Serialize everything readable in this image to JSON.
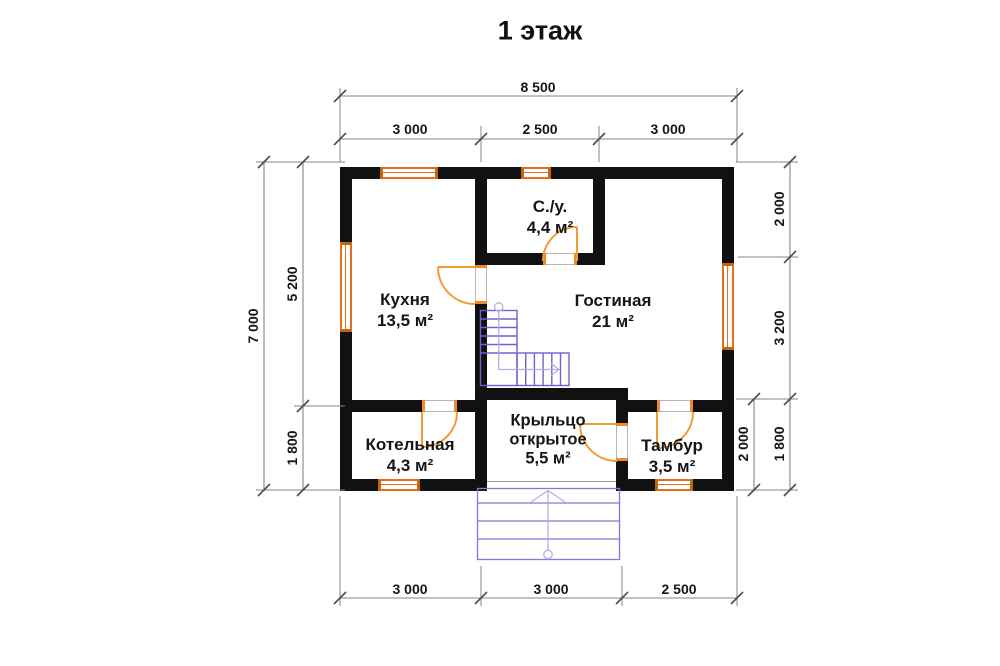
{
  "title": "1 этаж",
  "rooms": [
    {
      "id": "kitchen",
      "name": "Кухня",
      "area": "13,5 м²"
    },
    {
      "id": "bathroom",
      "name": "С./у.",
      "area": "4,4 м²"
    },
    {
      "id": "living",
      "name": "Гостиная",
      "area": "21 м²"
    },
    {
      "id": "boiler",
      "name": "Котельная",
      "area": "4,3 м²"
    },
    {
      "id": "porch",
      "name": "Крыльцо",
      "name2": "открытое",
      "area": "5,5 м²"
    },
    {
      "id": "tambour",
      "name": "Тамбур",
      "area": "3,5 м²"
    }
  ],
  "dimensions": {
    "top": {
      "overall": "8 500",
      "segments": [
        "3 000",
        "2 500",
        "3 000"
      ]
    },
    "bottom": {
      "segments": [
        "3 000",
        "3 000",
        "2 500"
      ]
    },
    "left": {
      "overall": "7 000",
      "segments": [
        "5 200",
        "1 800"
      ]
    },
    "right": {
      "segments": [
        "2 000",
        "3 200",
        "1 800"
      ],
      "tambour_height": "2 000"
    }
  },
  "colors": {
    "wall": "#111111",
    "window_frame": "#e0701c",
    "door": "#f29c38",
    "stairs": "#6f61cf",
    "walk_line": "#b7ace8",
    "porch_steps": "#8478d6",
    "dimension_line": "#808080",
    "text": "#161616"
  }
}
